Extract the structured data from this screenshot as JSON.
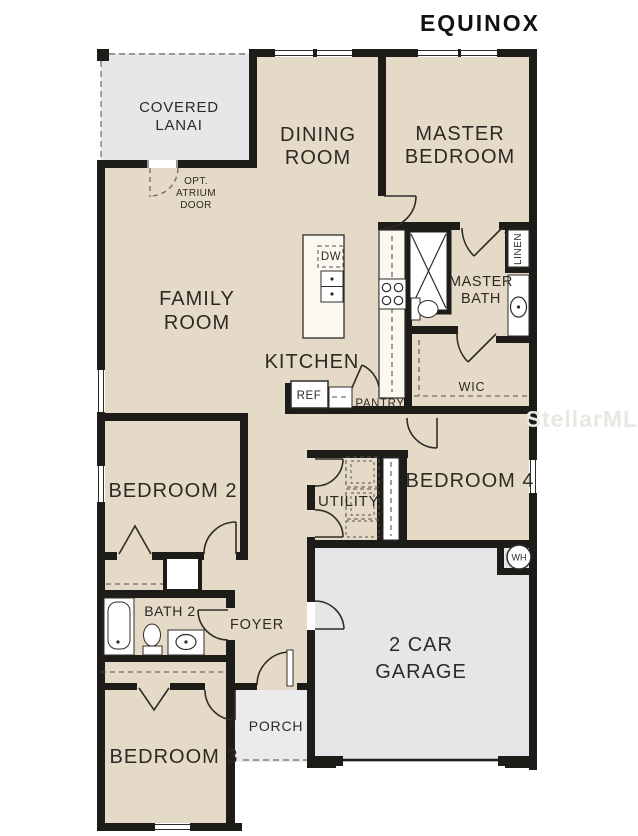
{
  "title": "EQUINOX",
  "watermark": "StellarMLS",
  "colors": {
    "room_fill": "#e4dac7",
    "lanai_fill": "#e7e7e9",
    "garage_fill": "#e6e6e8",
    "porch_fill": "#ebebed",
    "wall": "#1e1c18",
    "label_text": "#2d2a24"
  },
  "rooms": {
    "covered_lanai_1": "COVERED",
    "covered_lanai_2": "LANAI",
    "dining_1": "DINING",
    "dining_2": "ROOM",
    "master_bedroom_1": "MASTER",
    "master_bedroom_2": "BEDROOM",
    "family_1": "FAMILY",
    "family_2": "ROOM",
    "kitchen": "KITCHEN",
    "master_bath_1": "MASTER",
    "master_bath_2": "BATH",
    "wic": "WIC",
    "bedroom2": "BEDROOM 2",
    "utility": "UTILITY",
    "bedroom4": "BEDROOM 4",
    "bath2": "BATH 2",
    "foyer": "FOYER",
    "garage_1": "2 CAR",
    "garage_2": "GARAGE",
    "porch": "PORCH",
    "bedroom3": "BEDROOM 3"
  },
  "fixtures": {
    "dw": "DW",
    "ref": "REF",
    "pantry": "PANTRY",
    "linen": "LINEN",
    "wh": "WH"
  },
  "annotations": {
    "atrium_1": "OPT.",
    "atrium_2": "ATRIUM",
    "atrium_3": "DOOR"
  }
}
